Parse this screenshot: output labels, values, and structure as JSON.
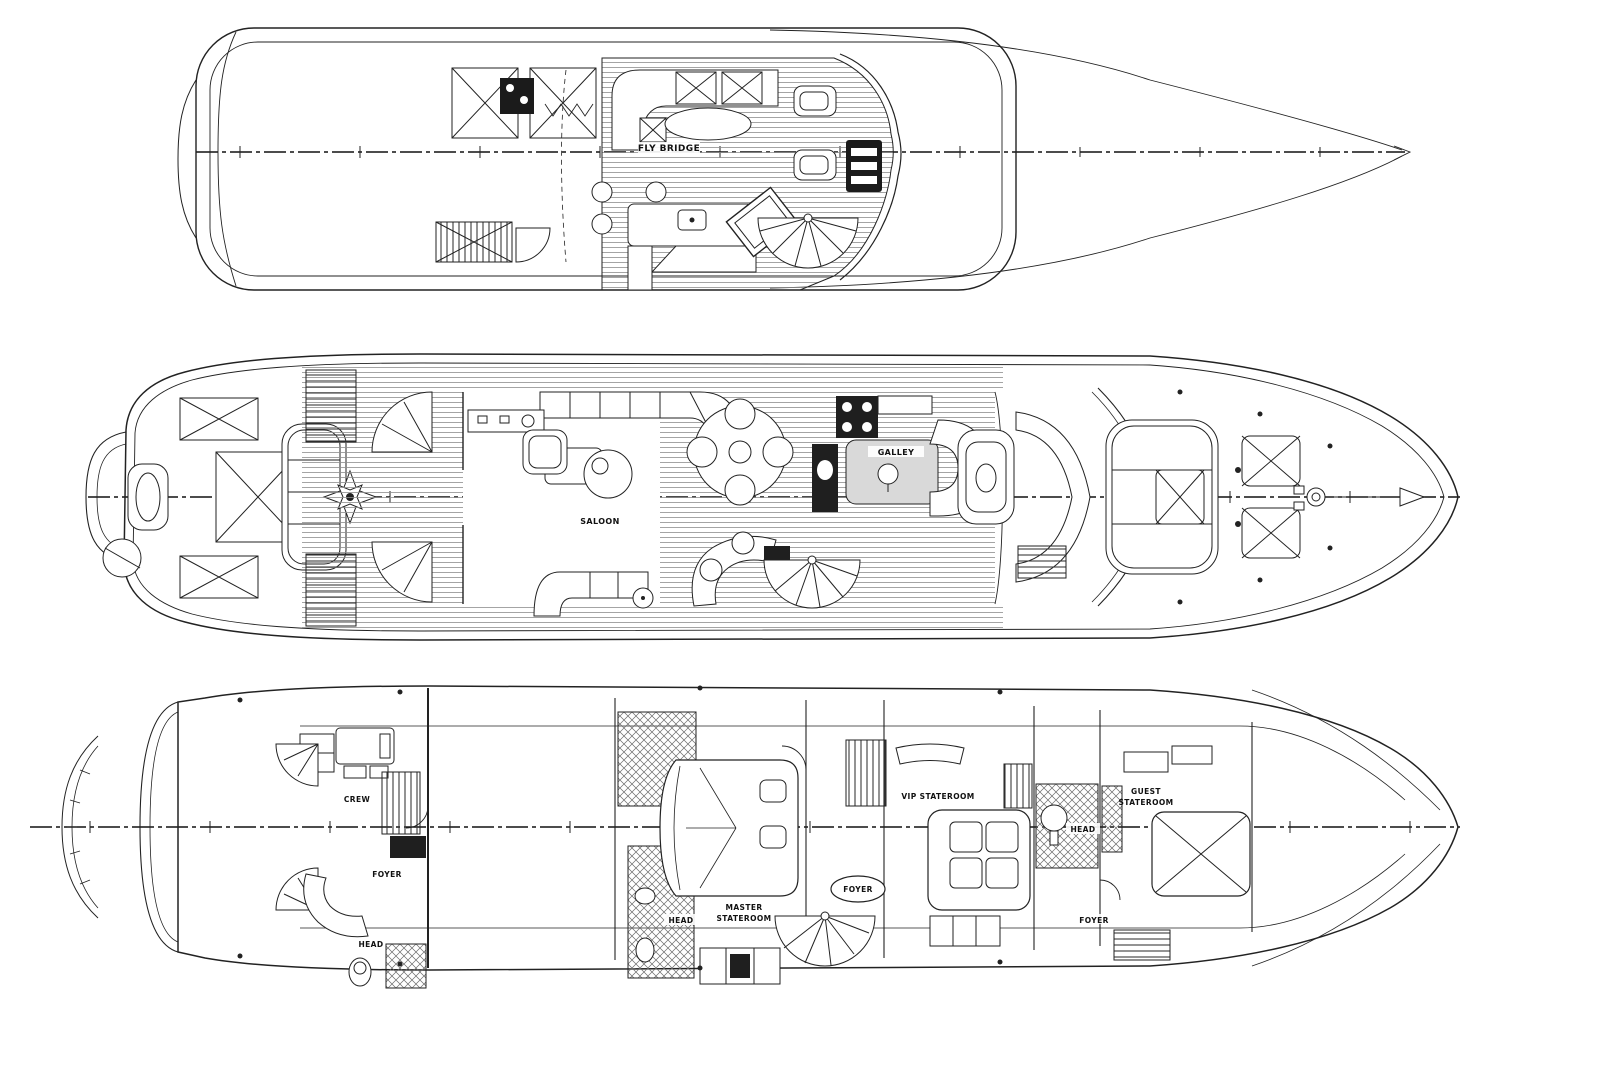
{
  "document": {
    "type": "yacht-deck-plan-blueprint",
    "views": [
      "flybridge deck",
      "main deck",
      "lower deck"
    ],
    "background_color": "#ffffff",
    "line_color": "#222222"
  },
  "decks": {
    "flybridge": {
      "name": "flybridge-deck",
      "labels": {
        "fly_bridge": "FLY BRIDGE"
      }
    },
    "main": {
      "name": "main-deck",
      "labels": {
        "saloon": "SALOON",
        "galley": "GALLEY"
      }
    },
    "lower": {
      "name": "lower-deck",
      "labels": {
        "crew": "CREW",
        "crew_foyer": "FOYER",
        "crew_head": "HEAD",
        "master_head": "HEAD",
        "master_1": "MASTER",
        "master_2": "STATEROOM",
        "foyer_oval": "FOYER",
        "vip": "VIP STATEROOM",
        "vip_head": "HEAD",
        "guest_1": "GUEST",
        "guest_2": "STATEROOM",
        "guest_foyer": "FOYER"
      }
    }
  }
}
